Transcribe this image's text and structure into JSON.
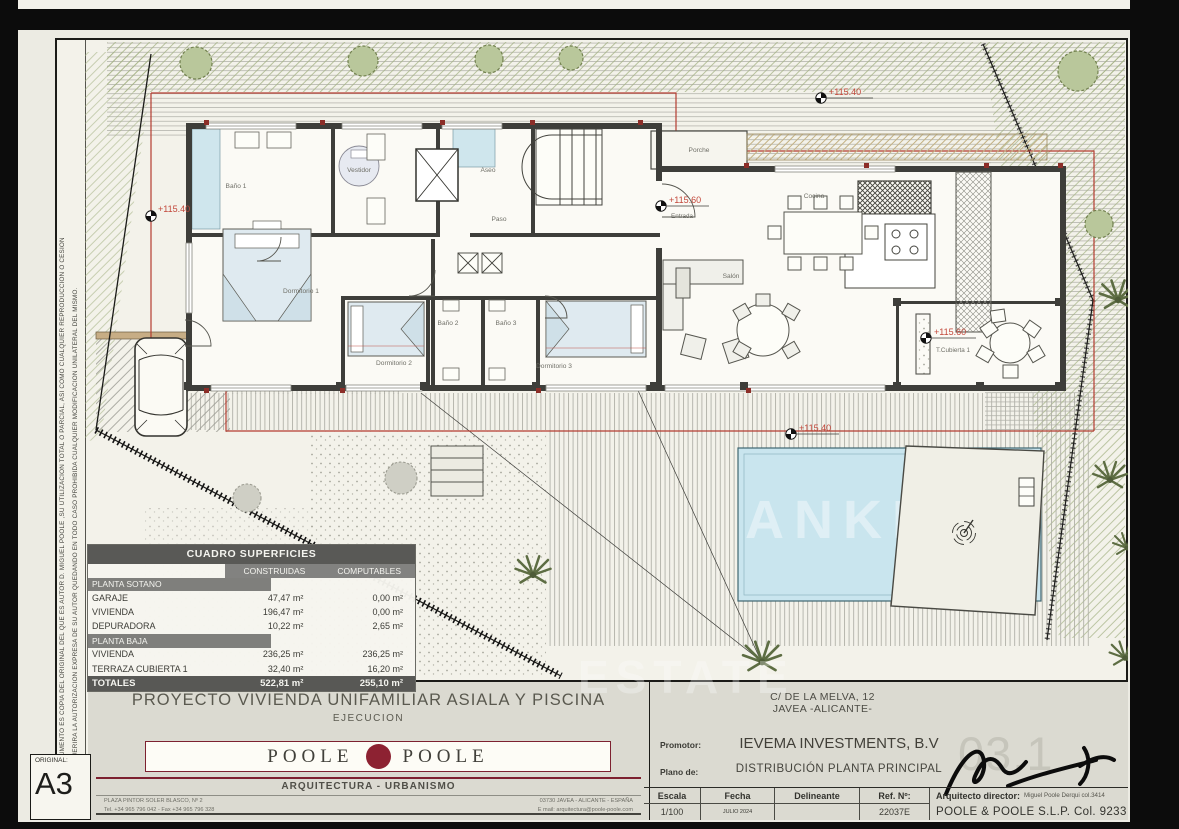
{
  "sheet": {
    "disclaimer_line1": "EL PRESENTE DOCUMENTO ES COPIA DEL ORIGINAL DEL QUE ES AUTOR D. MIGUEL POOLE ,SU UTILIZACION TOTAL O PARCIAL, ASI COMO CUALQUIER REPRODUCCION O CESION",
    "disclaimer_line2": "A TERCEROS, REQUERIRA LA AUTORIZACION EXPRESA DE SU AUTOR QUEDANDO EN TODO CASO PROHIBIDA CUALQUIER MODIFICACION UNILATERAL DEL MISMO.",
    "original_label": "ORIGINAL:",
    "original_size": "A3"
  },
  "plan": {
    "rooms": [
      "Baño 1",
      "Vestidor",
      "Aseo",
      "Dormitorio 1",
      "Paso",
      "Porche",
      "Cocina",
      "Salón",
      "Baño 2",
      "Baño 3",
      "Dormitorio 2",
      "Dormitorio 3"
    ],
    "levels": [
      {
        "value": "+115.40",
        "sublabel": ""
      },
      {
        "value": "+115.60",
        "sublabel": "Entrada"
      },
      {
        "value": "+115.60",
        "sublabel": "T.Cubierta 1"
      },
      {
        "value": "+115.40",
        "sublabel": ""
      },
      {
        "value": "+115.40",
        "sublabel": ""
      }
    ],
    "colors": {
      "wall": "#3e3e3a",
      "setback_red": "#b43d31",
      "pool_blue": "#c9e5ee",
      "level_red": "#c2473a"
    }
  },
  "areas_table": {
    "title": "CUADRO SUPERFICIES",
    "col_headers": [
      "CONSTRUIDAS",
      "COMPUTABLES"
    ],
    "sections": [
      {
        "name": "PLANTA SOTANO",
        "rows": [
          [
            "GARAJE",
            "47,47 m²",
            "0,00 m²"
          ],
          [
            "VIVIENDA",
            "196,47 m²",
            "0,00 m²"
          ],
          [
            "DEPURADORA",
            "10,22 m²",
            "2,65 m²"
          ]
        ]
      },
      {
        "name": "PLANTA BAJA",
        "rows": [
          [
            "VIVIENDA",
            "236,25 m²",
            "236,25 m²"
          ],
          [
            "TERRAZA CUBIERTA 1",
            "32,40 m²",
            "16,20 m²"
          ]
        ]
      }
    ],
    "totals": [
      "TOTALES",
      "522,81 m²",
      "255,10 m²"
    ]
  },
  "title_block": {
    "project_title": "PROYECTO VIVIENDA UNIFAMILIAR ASIALA Y PISCINA",
    "phase": "EJECUCION",
    "firm": {
      "name_left": "POOLE",
      "name_right": "POOLE",
      "tagline": "ARQUITECTURA - URBANISMO",
      "address_line1": "PLAZA PINTOR SOLER BLASCO, Nº 2",
      "address_line2": "Tel. +34 965 796 042  -  Fax +34 965 796 328",
      "address_line3": "03730 JAVEA - ALICANTE - ESPAÑA",
      "address_line4": "E mail: arquitectura@poole-poole.com"
    },
    "site_address_line1": "C/ DE LA MELVA, 12",
    "site_address_line2": "JAVEA -ALICANTE-",
    "promoter_label": "Promotor:",
    "promoter": "IEVEMA INVESTMENTS, B.V",
    "plan_label": "Plano de:",
    "plan_name": "DISTRIBUCIÓN PLANTA PRINCIPAL",
    "sheet_number": "03.1",
    "meta": {
      "escala_label": "Escala",
      "escala": "1/100",
      "fecha_label": "Fecha",
      "fecha": "JULIO 2024",
      "delineante_label": "Delineante",
      "delineante": "",
      "ref_label": "Ref. Nº:",
      "ref": "22037E",
      "arquitecto_label": "Arquitecto director:",
      "arquitecto": "Miguel Poole Derqui col.3414",
      "firm_line": "POOLE & POOLE S.L.P. Col. 9233"
    }
  },
  "watermark": {
    "pool": "ANKER",
    "bottom": "ESTATE"
  }
}
